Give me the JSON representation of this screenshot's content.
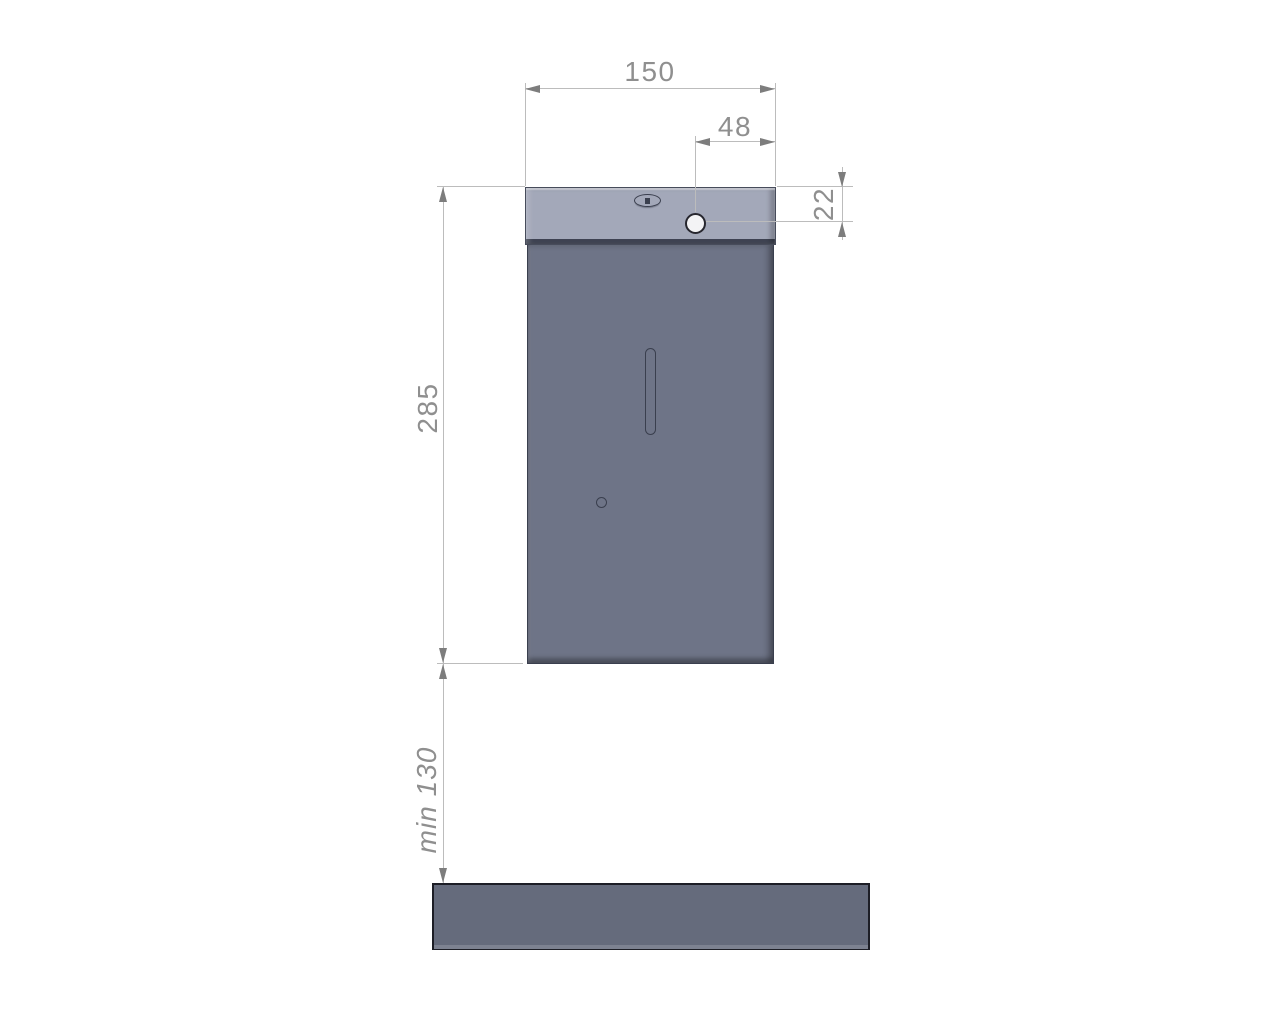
{
  "dims": {
    "width": "150",
    "hole_offset": "48",
    "hole_top_distance": "22",
    "body_height": "285",
    "min_clearance": "min 130"
  },
  "colors": {
    "cap_fill": "#a3a8b9",
    "body_fill": "#6e7487",
    "bar_fill": "#656b7c",
    "hole_fill": "#f3f3f5",
    "part_outline": "#3a3f4e",
    "dim_line": "#bcbcbc",
    "dim_text": "#8f8f8f",
    "arrow": "#7d7d7d"
  }
}
